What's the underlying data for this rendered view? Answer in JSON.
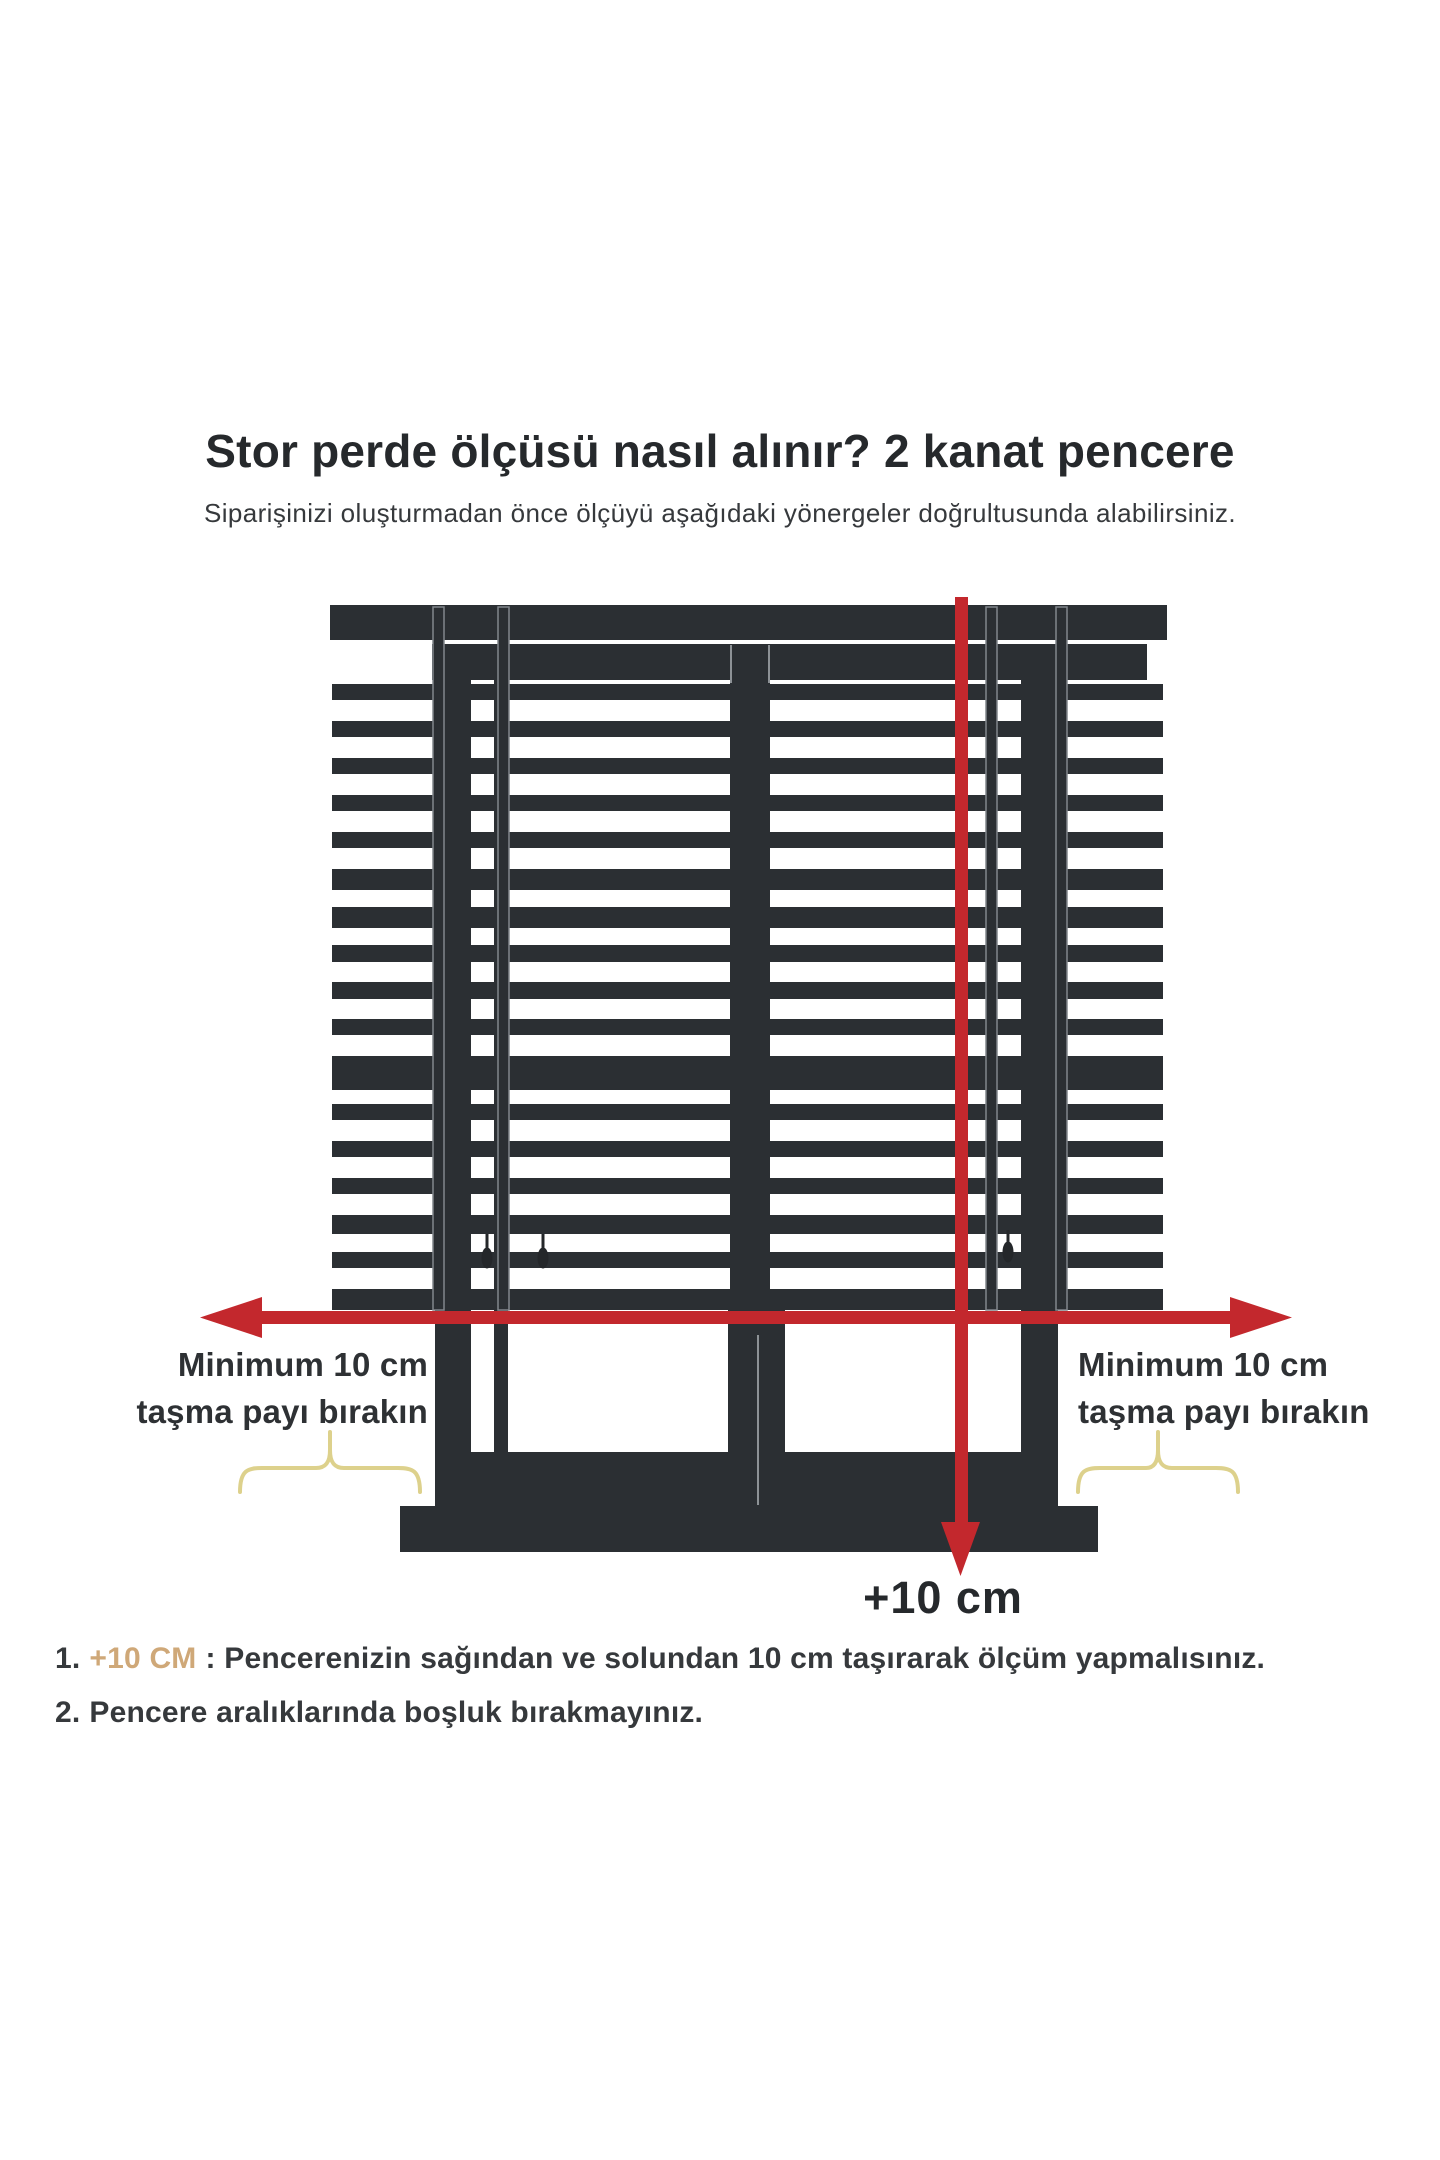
{
  "colors": {
    "dark": "#2b2f33",
    "red": "#c3282d",
    "gold_text": "#cfa878",
    "brace_gold": "#ddd18c",
    "text_primary": "#26292c",
    "text_secondary": "#36393c"
  },
  "header": {
    "title": "Stor perde ölçüsü nasıl alınır? 2 kanat pencere",
    "subtitle": "Siparişinizi oluşturmadan önce ölçüyü aşağıdaki yönergeler doğrultusunda alabilirsiniz."
  },
  "diagram": {
    "left_overhang_label": {
      "line1": "Minimum 10 cm",
      "line2": "taşma payı bırakın"
    },
    "right_overhang_label": {
      "line1": "Minimum 10 cm",
      "line2": "taşma payı bırakın"
    },
    "bottom_arrow_label": "+10 cm"
  },
  "instructions": {
    "item1": {
      "number": "1.",
      "highlight": "+10 CM",
      "text": ": Pencerenizin sağından ve solundan 10 cm taşırarak ölçüm yapmalısınız."
    },
    "item2": {
      "number": "2.",
      "text": "Pencere aralıklarında boşluk bırakmayınız."
    }
  }
}
